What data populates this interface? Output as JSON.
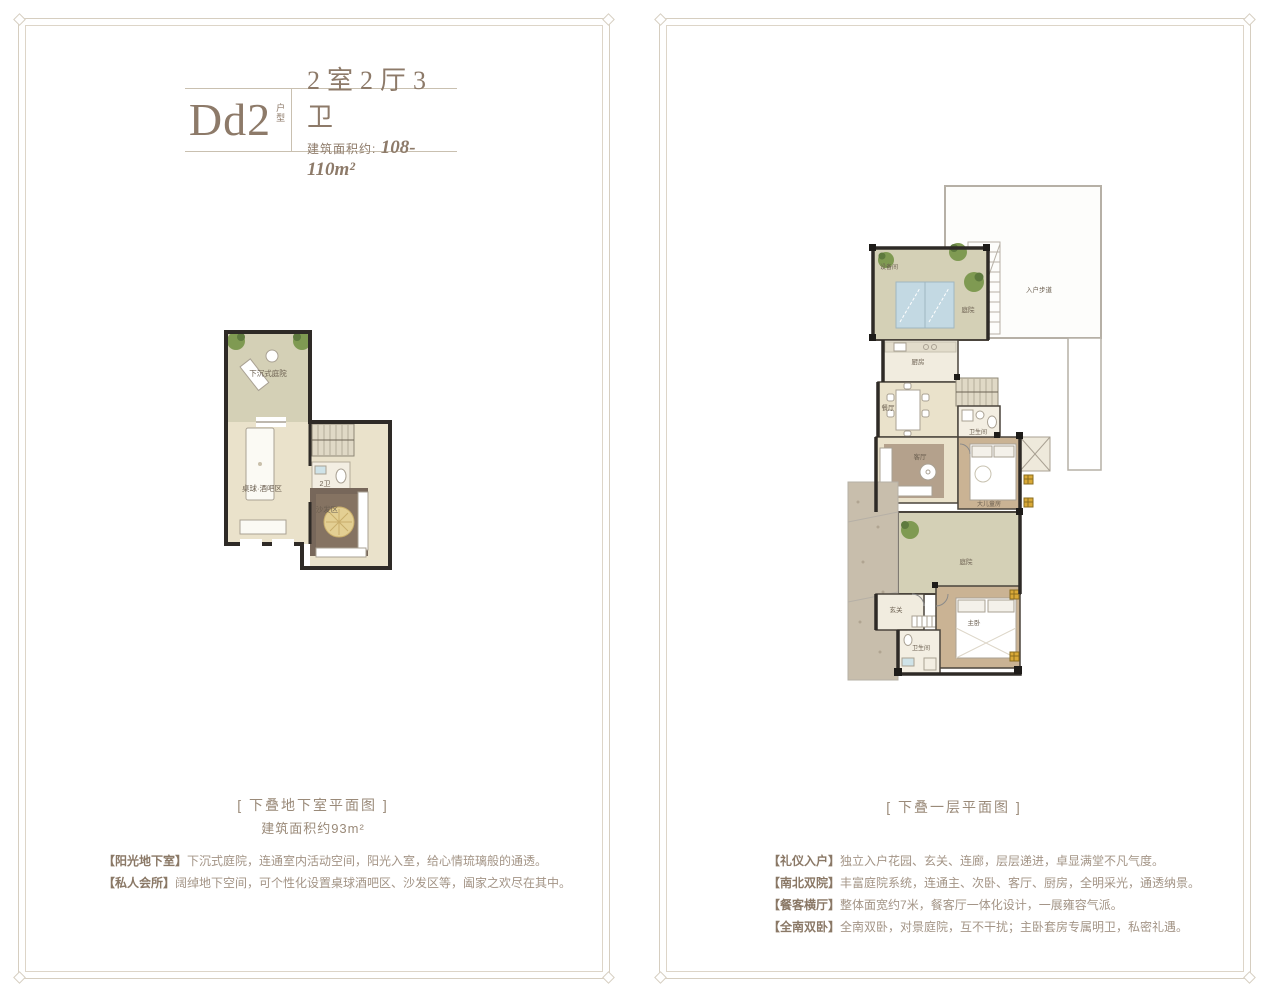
{
  "left_panel": {
    "title": {
      "code": "Dd2",
      "code_tag": "户型",
      "rooms": "2室2厅3卫",
      "area_label": "建筑面积约:",
      "area_value": "108-110m²"
    },
    "plan_labels": {
      "sunken_courtyard": "下沉式庭院",
      "billiard_bar": "桌球·酒吧区",
      "bath": "2卫",
      "sofa_area": "沙发区"
    },
    "caption": "[ 下叠地下室平面图 ]",
    "caption_area": "建筑面积约93m²",
    "descriptions": [
      {
        "tag": "【阳光地下室】",
        "text": "下沉式庭院，连通室内活动空间，阳光入室，给心情琉璃般的通透。"
      },
      {
        "tag": "【私人会所】",
        "text": "阔绰地下空间，可个性化设置桌球酒吧区、沙发区等，阖家之欢尽在其中。"
      }
    ]
  },
  "right_panel": {
    "plan_labels": {
      "equipment": "设备间",
      "courtyard_north": "庭院",
      "entry_walk": "入户步道",
      "kitchen": "厨房",
      "dining": "餐厅",
      "bath_1": "卫生间",
      "living": "客厅",
      "kids_room": "大儿童房",
      "courtyard_south": "庭院",
      "foyer": "玄关",
      "master": "主卧",
      "bath_2": "卫生间"
    },
    "caption": "[ 下叠一层平面图 ]",
    "descriptions": [
      {
        "tag": "【礼仪入户】",
        "text": "独立入户花园、玄关、连廊，层层递进，卓显满堂不凡气度。"
      },
      {
        "tag": "【南北双院】",
        "text": "丰富庭院系统，连通主、次卧、客厅、厨房，全明采光，通透纳景。"
      },
      {
        "tag": "【餐客横厅】",
        "text": "整体面宽约7米，餐客厅一体化设计，一展雍容气派。"
      },
      {
        "tag": "【全南双卧】",
        "text": "全南双卧，对景庭院，互不干扰；主卧套房专属明卫，私密礼遇。"
      }
    ]
  }
}
